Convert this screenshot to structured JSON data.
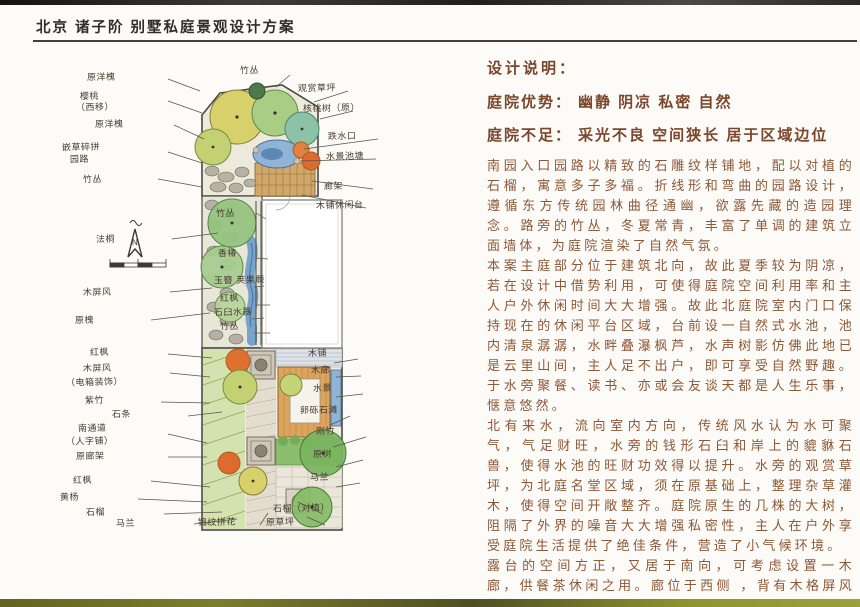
{
  "title": "北京 诸子阶 别墅私庭景观设计方案",
  "notes": {
    "heading": "设计说明：",
    "pros_label": "庭院优势：",
    "pros": "幽静 阴凉 私密 自然",
    "cons_label": "庭院不足：",
    "cons": "采光不良 空间狭长 居于区域边位",
    "paragraphs": [
      "南园入口园路以精致的石雕纹样铺地，配以对植的石榴，寓意多子多福。折线形和弯曲的园路设计，遵循东方传统园林曲径通幽，欲露先藏的造园理念。路旁的竹丛，冬夏常青，丰富了单调的建筑立面墙体，为庭院渲染了自然气氛。",
      "本案主庭部分位于建筑北向，故此夏季较为阴凉，若在设计中借势利用，可使得庭院空间利用率和主人户外休闲时间大大增强。故此北庭院室内门口保持现在的休闲平台区域，台前设一自然式水池，池内清泉潺潺，水畔叠瀑枫芦，水声树影仿佛此地已是云里山间，主人足不出户，即可享受自然野趣。于水旁聚餐、读书、亦或会友谈天都是人生乐事，惬意悠然。",
      "北有来水，流向室内方向，传统风水认为水可聚气，气足财旺，水旁的钱形石臼和岸上的貔貅石兽，使得水池的旺财功效得以提升。水旁的观赏草坪，为北庭名堂区域，须在原基础上，整理杂草灌木，使得空间开敞整齐。庭院原生的几株的大树，阻隔了外界的噪音大大增强私密性，主人在户外享受庭院生活提供了绝佳条件，营造了小气候环境。",
      "露台的空间方正，又居于南向，可考虑设置一木廊，供餐茶休闲之用。廊位于西侧 ，背有木格屏风格挡夏日西晒。"
    ]
  },
  "plan": {
    "compass": "N",
    "labels": [
      "原洋槐",
      "樱桃",
      "（西移）",
      "原洋槐",
      "嵌草碎拼",
      "园路",
      "竹丛",
      "法桐",
      "木屏风",
      "原槐",
      "红枫",
      "木屏风",
      "（电箱装饰）",
      "紫竹",
      "石条",
      "南通道",
      "（人字铺）",
      "原廊架",
      "红枫",
      "黄杨",
      "石榴",
      "马兰",
      "竹丛",
      "观赏草坪",
      "核桃树（原）",
      "跌水口",
      "水景池塘",
      "廊架",
      "木铺休闲台",
      "竹丛",
      "香椿",
      "玉簪 荚果蕨",
      "红枫",
      "石臼水器",
      "竹丛",
      "木铺",
      "木廊",
      "水景",
      "卵砾石滩",
      "刚竹",
      "原树",
      "马兰",
      "石榴（对植）",
      "锦纹拼花",
      "原草坪"
    ]
  },
  "colors": {
    "heading_brown": "#79452b",
    "body_brown": "#8c5838",
    "ink": "#463c30",
    "tree_green": "#94c27e",
    "water_blue": "#8fb4d8",
    "deck_tan": "#d2a86a"
  }
}
